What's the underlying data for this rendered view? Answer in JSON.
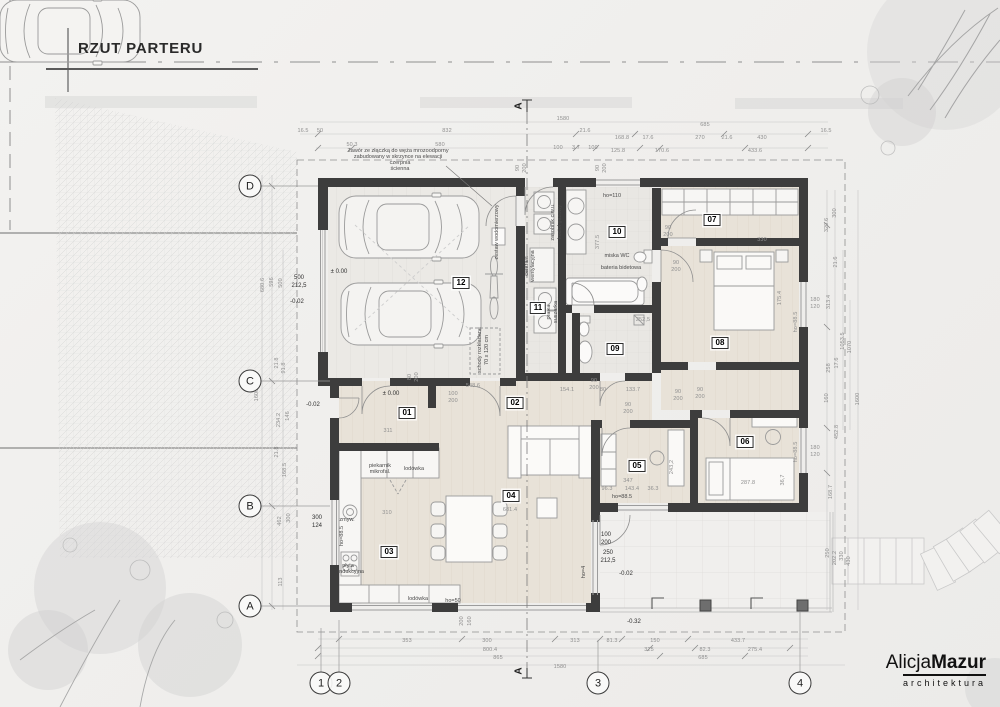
{
  "title": "RZUT PARTERU",
  "logo": {
    "first": "Alicja",
    "bold": "Mazur",
    "sub": "architektura"
  },
  "grid": {
    "letters": [
      {
        "t": "D",
        "x": 250,
        "y": 186
      },
      {
        "t": "C",
        "x": 250,
        "y": 381
      },
      {
        "t": "B",
        "x": 250,
        "y": 506
      },
      {
        "t": "A",
        "x": 250,
        "y": 606
      }
    ],
    "numbers": [
      {
        "t": "1",
        "x": 321,
        "y": 683
      },
      {
        "t": "2",
        "x": 339,
        "y": 683
      },
      {
        "t": "3",
        "x": 598,
        "y": 683
      },
      {
        "t": "4",
        "x": 800,
        "y": 683
      }
    ],
    "sections": [
      {
        "t": "A",
        "x": 519,
        "y": 106,
        "r": -90
      },
      {
        "t": "A",
        "x": 519,
        "y": 671,
        "r": -90
      }
    ]
  },
  "rooms": [
    {
      "t": "01",
      "x": 407,
      "y": 413
    },
    {
      "t": "02",
      "x": 515,
      "y": 403
    },
    {
      "t": "03",
      "x": 389,
      "y": 552
    },
    {
      "t": "04",
      "x": 511,
      "y": 496
    },
    {
      "t": "05",
      "x": 637,
      "y": 466
    },
    {
      "t": "06",
      "x": 745,
      "y": 442
    },
    {
      "t": "07",
      "x": 712,
      "y": 220
    },
    {
      "t": "08",
      "x": 720,
      "y": 343
    },
    {
      "t": "09",
      "x": 615,
      "y": 349
    },
    {
      "t": "10",
      "x": 617,
      "y": 232
    },
    {
      "t": "11",
      "x": 538,
      "y": 308
    },
    {
      "t": "12",
      "x": 461,
      "y": 283
    }
  ],
  "annotations": [
    {
      "t": "Zawór ze złączką do węża mrozoodporny",
      "x": 398,
      "y": 151
    },
    {
      "t": "zabudowany w skrzynce na elewacji",
      "x": 398,
      "y": 157
    },
    {
      "t": "czerpnia",
      "x": 400,
      "y": 163
    },
    {
      "t": "ścienna",
      "x": 400,
      "y": 169
    },
    {
      "t": "zestaw wodomierzowy",
      "x": 497,
      "y": 232,
      "r": -90
    },
    {
      "t": "schody rozkładane",
      "x": 480,
      "y": 350,
      "r": -90
    },
    {
      "t": "70 x 120 cm",
      "x": 487,
      "y": 350,
      "r": -90
    },
    {
      "t": "zasobnik c.w.u.",
      "x": 553,
      "y": 222,
      "r": -90
    },
    {
      "t": "kocioł gazowy",
      "x": 560,
      "y": 222,
      "r": -90
    },
    {
      "t": "centrala",
      "x": 527,
      "y": 266,
      "r": -90
    },
    {
      "t": "wentylacyjna",
      "x": 533,
      "y": 266,
      "r": -90
    },
    {
      "t": "pralka",
      "x": 549,
      "y": 312,
      "r": -90
    },
    {
      "t": "suszarka",
      "x": 556,
      "y": 312,
      "r": -90
    },
    {
      "t": "miska WC",
      "x": 617,
      "y": 256
    },
    {
      "t": "bateria bidetowa",
      "x": 621,
      "y": 268
    },
    {
      "t": "ho=110",
      "x": 612,
      "y": 196
    },
    {
      "t": "piekarnik",
      "x": 380,
      "y": 466
    },
    {
      "t": "mikrofal.",
      "x": 380,
      "y": 472
    },
    {
      "t": "lodówka",
      "x": 414,
      "y": 469
    },
    {
      "t": "zmyw.",
      "x": 347,
      "y": 520
    },
    {
      "t": "płyta",
      "x": 348,
      "y": 566
    },
    {
      "t": "indukcyjna",
      "x": 351,
      "y": 572
    },
    {
      "t": "lodówka",
      "x": 418,
      "y": 599
    },
    {
      "t": "ho=50",
      "x": 453,
      "y": 601
    },
    {
      "t": "ho=88.5",
      "x": 342,
      "y": 536,
      "r": -90
    },
    {
      "t": "ho=88.5",
      "x": 622,
      "y": 497
    },
    {
      "t": "ho=4",
      "x": 584,
      "y": 572,
      "r": -90
    },
    {
      "t": "ho=88.5",
      "x": 796,
      "y": 322,
      "r": -90,
      "c": "dim"
    },
    {
      "t": "ho=88.5",
      "x": 796,
      "y": 452,
      "r": -90,
      "c": "dim"
    },
    {
      "t": "± 0.00",
      "x": 339,
      "y": 272,
      "c": "lvl"
    },
    {
      "t": "± 0.00",
      "x": 391,
      "y": 394,
      "c": "lvl"
    },
    {
      "t": "-0.02",
      "x": 297,
      "y": 302,
      "c": "lvl"
    },
    {
      "t": "-0.02",
      "x": 313,
      "y": 405,
      "c": "lvl"
    },
    {
      "t": "-0.02",
      "x": 626,
      "y": 574,
      "c": "lvl"
    },
    {
      "t": "-0.32",
      "x": 634,
      "y": 622,
      "c": "lvl"
    },
    {
      "t": "500",
      "x": 299,
      "y": 278,
      "c": "lvl"
    },
    {
      "t": "212,5",
      "x": 299,
      "y": 286,
      "c": "lvl"
    },
    {
      "t": "300",
      "x": 317,
      "y": 518,
      "c": "lvl"
    },
    {
      "t": "124",
      "x": 317,
      "y": 526,
      "c": "lvl"
    },
    {
      "t": "100",
      "x": 606,
      "y": 535,
      "c": "lvl"
    },
    {
      "t": "200",
      "x": 606,
      "y": 543,
      "c": "lvl"
    },
    {
      "t": "250",
      "x": 608,
      "y": 553,
      "c": "lvl"
    },
    {
      "t": "212,5",
      "x": 608,
      "y": 561,
      "c": "lvl"
    }
  ],
  "dimensions": [
    {
      "t": "1580",
      "x": 563,
      "y": 119
    },
    {
      "t": "16.5",
      "x": 303,
      "y": 131
    },
    {
      "t": "50",
      "x": 320,
      "y": 131
    },
    {
      "t": "832",
      "x": 447,
      "y": 131
    },
    {
      "t": "21.6",
      "x": 585,
      "y": 131
    },
    {
      "t": "168.8",
      "x": 622,
      "y": 138
    },
    {
      "t": "17.6",
      "x": 648,
      "y": 138
    },
    {
      "t": "270",
      "x": 700,
      "y": 138
    },
    {
      "t": "21.6",
      "x": 727,
      "y": 138
    },
    {
      "t": "685",
      "x": 705,
      "y": 125
    },
    {
      "t": "430",
      "x": 762,
      "y": 138
    },
    {
      "t": "16.5",
      "x": 826,
      "y": 131
    },
    {
      "t": "50.3",
      "x": 352,
      "y": 145
    },
    {
      "t": "580",
      "x": 440,
      "y": 145
    },
    {
      "t": "100",
      "x": 558,
      "y": 148
    },
    {
      "t": "3.7",
      "x": 576,
      "y": 148
    },
    {
      "t": "100",
      "x": 593,
      "y": 148
    },
    {
      "t": "125.8",
      "x": 618,
      "y": 151
    },
    {
      "t": "170.6",
      "x": 662,
      "y": 151
    },
    {
      "t": "433.6",
      "x": 755,
      "y": 151
    },
    {
      "t": "353",
      "x": 407,
      "y": 641
    },
    {
      "t": "300",
      "x": 487,
      "y": 641
    },
    {
      "t": "313",
      "x": 575,
      "y": 641
    },
    {
      "t": "81.3",
      "x": 612,
      "y": 641
    },
    {
      "t": "150",
      "x": 655,
      "y": 641
    },
    {
      "t": "433.7",
      "x": 738,
      "y": 641
    },
    {
      "t": "800.4",
      "x": 490,
      "y": 650
    },
    {
      "t": "325",
      "x": 649,
      "y": 650
    },
    {
      "t": "82.3",
      "x": 705,
      "y": 650
    },
    {
      "t": "275.4",
      "x": 755,
      "y": 650
    },
    {
      "t": "865",
      "x": 498,
      "y": 658
    },
    {
      "t": "685",
      "x": 703,
      "y": 658
    },
    {
      "t": "1580",
      "x": 560,
      "y": 667
    },
    {
      "t": "200",
      "x": 462,
      "y": 621,
      "r": -90
    },
    {
      "t": "160",
      "x": 470,
      "y": 621,
      "r": -90
    },
    {
      "t": "680.6",
      "x": 263,
      "y": 285,
      "r": -90
    },
    {
      "t": "596",
      "x": 272,
      "y": 282,
      "r": -90
    },
    {
      "t": "500",
      "x": 281,
      "y": 283,
      "r": -90
    },
    {
      "t": "21.8",
      "x": 277,
      "y": 363,
      "r": -90
    },
    {
      "t": "91.8",
      "x": 284,
      "y": 368,
      "r": -90
    },
    {
      "t": "1600",
      "x": 257,
      "y": 395,
      "r": -90
    },
    {
      "t": "234.2",
      "x": 279,
      "y": 420,
      "r": -90
    },
    {
      "t": "146",
      "x": 288,
      "y": 416,
      "r": -90
    },
    {
      "t": "21.8",
      "x": 277,
      "y": 452,
      "r": -90
    },
    {
      "t": "168.5",
      "x": 285,
      "y": 470,
      "r": -90
    },
    {
      "t": "462",
      "x": 280,
      "y": 521,
      "r": -90
    },
    {
      "t": "300",
      "x": 289,
      "y": 518,
      "r": -90
    },
    {
      "t": "113",
      "x": 281,
      "y": 582,
      "r": -90
    },
    {
      "t": "320.6",
      "x": 827,
      "y": 225,
      "r": -90
    },
    {
      "t": "300",
      "x": 835,
      "y": 213,
      "r": -90
    },
    {
      "t": "21.6",
      "x": 836,
      "y": 262,
      "r": -90
    },
    {
      "t": "313.4",
      "x": 829,
      "y": 302,
      "r": -90
    },
    {
      "t": "180",
      "x": 815,
      "y": 300
    },
    {
      "t": "120",
      "x": 815,
      "y": 307
    },
    {
      "t": "1053.5",
      "x": 843,
      "y": 341,
      "r": -90
    },
    {
      "t": "1070",
      "x": 850,
      "y": 347,
      "r": -90
    },
    {
      "t": "17.6",
      "x": 837,
      "y": 363,
      "r": -90
    },
    {
      "t": "258",
      "x": 829,
      "y": 368,
      "r": -90
    },
    {
      "t": "1600",
      "x": 858,
      "y": 399,
      "r": -90
    },
    {
      "t": "160",
      "x": 827,
      "y": 398,
      "r": -90
    },
    {
      "t": "452.8",
      "x": 837,
      "y": 432,
      "r": -90
    },
    {
      "t": "180",
      "x": 815,
      "y": 448
    },
    {
      "t": "120",
      "x": 815,
      "y": 455
    },
    {
      "t": "168.7",
      "x": 831,
      "y": 492,
      "r": -90
    },
    {
      "t": "250",
      "x": 828,
      "y": 553,
      "r": -90
    },
    {
      "t": "202.2",
      "x": 835,
      "y": 558,
      "r": -90
    },
    {
      "t": "330",
      "x": 842,
      "y": 556,
      "r": -90
    },
    {
      "t": "430",
      "x": 849,
      "y": 561,
      "r": -90
    },
    {
      "t": "311",
      "x": 388,
      "y": 431
    },
    {
      "t": "310",
      "x": 387,
      "y": 513
    },
    {
      "t": "681.4",
      "x": 510,
      "y": 510
    },
    {
      "t": "548.6",
      "x": 473,
      "y": 386
    },
    {
      "t": "100",
      "x": 453,
      "y": 394
    },
    {
      "t": "200",
      "x": 453,
      "y": 401
    },
    {
      "t": "80",
      "x": 410,
      "y": 377,
      "r": -90
    },
    {
      "t": "200",
      "x": 417,
      "y": 377,
      "r": -90
    },
    {
      "t": "90",
      "x": 518,
      "y": 168,
      "r": -90
    },
    {
      "t": "200",
      "x": 525,
      "y": 168,
      "r": -90
    },
    {
      "t": "90",
      "x": 598,
      "y": 168,
      "r": -90
    },
    {
      "t": "200",
      "x": 605,
      "y": 168,
      "r": -90
    },
    {
      "t": "377.5",
      "x": 598,
      "y": 242,
      "r": -90
    },
    {
      "t": "252,5",
      "x": 643,
      "y": 320
    },
    {
      "t": "154.1",
      "x": 567,
      "y": 390
    },
    {
      "t": "80",
      "x": 603,
      "y": 390
    },
    {
      "t": "133.7",
      "x": 633,
      "y": 390
    },
    {
      "t": "90",
      "x": 594,
      "y": 381
    },
    {
      "t": "200",
      "x": 594,
      "y": 388
    },
    {
      "t": "90",
      "x": 678,
      "y": 392
    },
    {
      "t": "200",
      "x": 678,
      "y": 399
    },
    {
      "t": "90",
      "x": 668,
      "y": 228
    },
    {
      "t": "200",
      "x": 668,
      "y": 235
    },
    {
      "t": "90",
      "x": 676,
      "y": 263
    },
    {
      "t": "200",
      "x": 676,
      "y": 270
    },
    {
      "t": "330",
      "x": 762,
      "y": 240
    },
    {
      "t": "175.4",
      "x": 780,
      "y": 298,
      "r": -90
    },
    {
      "t": "90",
      "x": 700,
      "y": 390
    },
    {
      "t": "200",
      "x": 700,
      "y": 397
    },
    {
      "t": "90",
      "x": 628,
      "y": 405
    },
    {
      "t": "200",
      "x": 628,
      "y": 412
    },
    {
      "t": "347",
      "x": 628,
      "y": 481
    },
    {
      "t": "96.3",
      "x": 607,
      "y": 489
    },
    {
      "t": "143.4",
      "x": 632,
      "y": 489
    },
    {
      "t": "36.3",
      "x": 653,
      "y": 489
    },
    {
      "t": "243,2",
      "x": 672,
      "y": 467,
      "r": -90
    },
    {
      "t": "287.8",
      "x": 748,
      "y": 483
    },
    {
      "t": "36,7",
      "x": 783,
      "y": 480,
      "r": -90
    }
  ]
}
